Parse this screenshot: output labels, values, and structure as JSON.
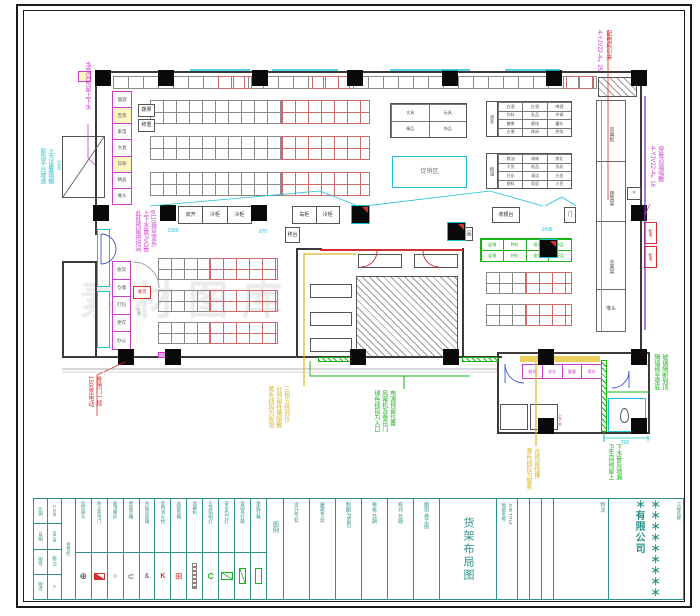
{
  "watermark": "素材图库",
  "ann": {
    "left_top_magenta": [
      "净菜间预留上下水"
    ],
    "left_cyan": [
      "卸货平台坡道",
      "上方设置雨棚"
    ],
    "left_mid_magenta": [
      "此处预留烘焙间",
      "上下水管PVC管",
      "φ110排至室外"
    ],
    "left_bottom_red": [
      "1500宽电动",
      "卷闸门一樘"
    ],
    "bottom_yellow": [
      "黄色线段为收银",
      "台预留线槽暗敷",
      "三相五线到位"
    ],
    "bottom_green": [
      "绿色线段为入口",
      "风幕机及卷帘门",
      "电源预留位置"
    ],
    "annex_yellow": [
      "黄色线段为服务",
      "台预留线槽"
    ],
    "annex_green": [
      "隔墙砌至梁底",
      "玻璃隔断到顶"
    ],
    "toilet_green": [
      "卫生间预留上",
      "下水管及地漏"
    ],
    "right_magenta": [
      "4-YJV22-4×16",
      "穿管沿墙暗敷"
    ],
    "tr_red": [
      "配电房引来"
    ],
    "tr_magenta": [
      "4-YJV22-4×25"
    ],
    "ramp_dim": "3000"
  },
  "dims": {
    "d1500": "1500",
    "d970": "970",
    "d1436": "1436",
    "d700": "700",
    "d100": "100",
    "d300": "300"
  },
  "fixtures": {
    "left_stack": [
      "烟酒",
      "百货",
      "家电",
      "文具",
      "日杂",
      "精品",
      "堆头"
    ],
    "bl_stack": [
      "收货",
      "仓储",
      "打包",
      "更衣",
      "办公"
    ],
    "small_box1": "蔬果",
    "small_box2": "称重",
    "small_box3": "称台",
    "small_box4": "赠品",
    "checkout3": [
      "双开",
      "冷柜",
      "冷柜"
    ],
    "checkout2": [
      "岛柜",
      "冷柜"
    ],
    "gate_label": "收银台",
    "gate_small": "门",
    "table2x2": [
      "文具",
      "玩具",
      "精品",
      "饰品"
    ],
    "promo": "促销区",
    "grid1_label": "酒水",
    "grid1": [
      "白酒",
      "红酒",
      "啤酒",
      "饮料",
      "乳品",
      "冲调",
      "糖果",
      "蜜饯",
      "罐头",
      "方便",
      "休闲",
      "烘焙"
    ],
    "grid2_label": "粮油",
    "grid2": [
      "粮油",
      "调味",
      "南北",
      "干货",
      "纸品",
      "洗化",
      "日化",
      "清洁",
      "五金",
      "塑料",
      "家居",
      "小百"
    ],
    "green_table": [
      "促销",
      "特价",
      "堆头",
      "新品",
      "促销",
      "特价",
      "堆头",
      "新品"
    ],
    "corridor": [
      "风幕柜",
      "蔬菜架",
      "水果架"
    ],
    "corridor_end": "堆头",
    "annex_fixtures": [
      "服务",
      "总台",
      "客服",
      "寄存"
    ],
    "annex_red": "上下水",
    "toilet": "卫",
    "power_boxes": [
      "配电",
      "配电"
    ],
    "x_mark": "✕",
    "red_box_label": "收货"
  },
  "legend": {
    "header": "图例",
    "items": [
      "监控探头",
      "防火卷帘门",
      "吸顶喇叭",
      "壁挂音箱",
      "吊挂双音箱",
      "室内消火栓",
      "总配电箱",
      "风幕机",
      "应急照明灯",
      "安全出口灯",
      "双面吊灯箱",
      "单面灯箱"
    ]
  },
  "titleblock": {
    "infoA": [
      "比例",
      "日期",
      "图号",
      "版次"
    ],
    "infoB": [
      "1:100",
      "08.06",
      "施-01",
      "A"
    ],
    "infoC": [
      "会签栏"
    ],
    "fields": [
      "设计专业:",
      "建筑专业:",
      "制图:PM&D",
      "审核:日期",
      "校对:日期",
      "图别:施工图"
    ],
    "job_label": "图纸名称:",
    "job_label_en": "JOB TITLE",
    "title": "货架布局图",
    "note_label": "特注:",
    "project_label": "工程名称:",
    "company": "＊＊＊＊＊＊＊＊＊＊有限公司"
  },
  "colors": {
    "teal": "#2e9188",
    "magenta": "#c93ec9",
    "cyan": "#1ec0d8",
    "green": "#17b317",
    "red": "#d43030",
    "yellow": "#d9b520",
    "purple": "#7b2fd0"
  }
}
